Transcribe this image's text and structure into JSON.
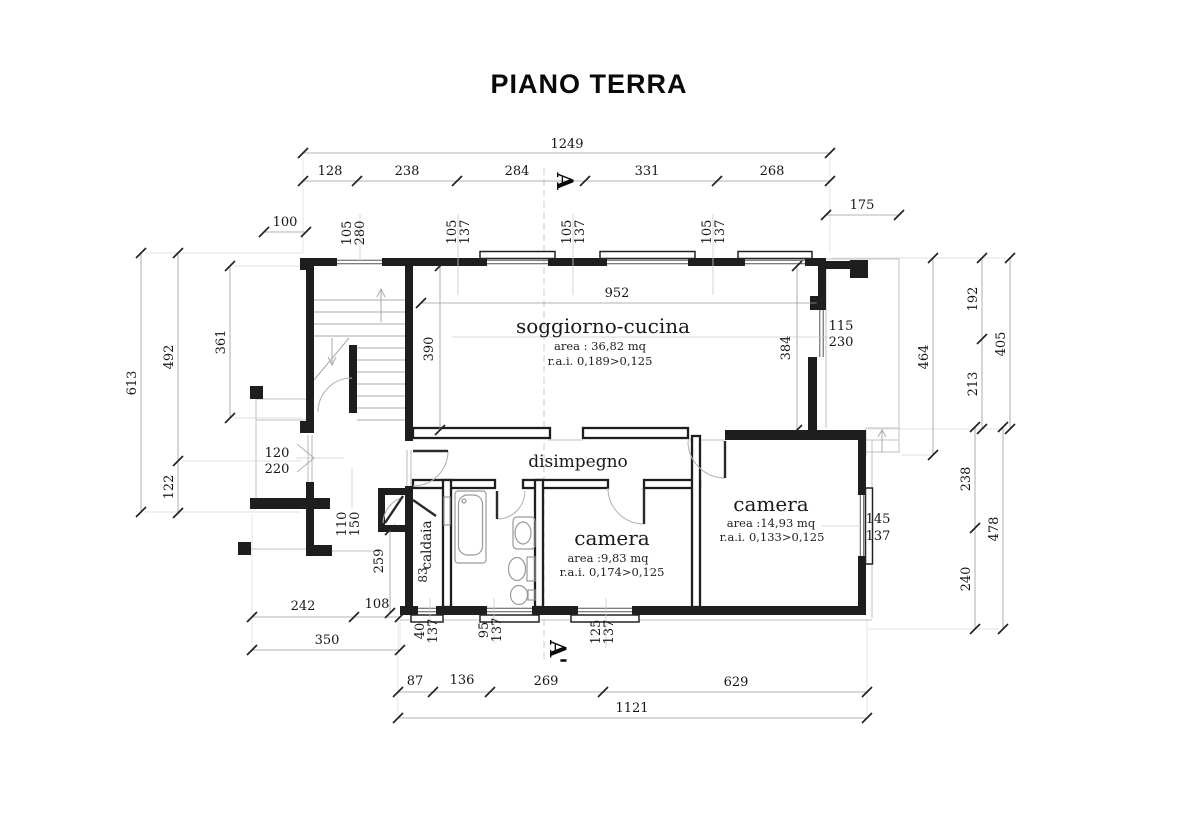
{
  "title": "PIANO TERRA",
  "section": {
    "marker_top": "A",
    "marker_bottom": "A'"
  },
  "rooms": {
    "soggiorno": {
      "name": "soggiorno-cucina",
      "area": "area : 36,82 mq",
      "rai": "r.a.i. 0,189>0,125"
    },
    "disimpegno": {
      "name": "disimpegno"
    },
    "camera_small": {
      "name": "camera",
      "area": "area :9,83 mq",
      "rai": "r.a.i. 0,174>0,125"
    },
    "camera_large": {
      "name": "camera",
      "area": "area :14,93 mq",
      "rai": "r.a.i. 0,133>0,125"
    },
    "caldaia": {
      "name": "caldaia"
    }
  },
  "dims": {
    "top_total": "1249",
    "top_chain": [
      "128",
      "238",
      "284",
      "331",
      "268"
    ],
    "porch_width": "100",
    "terrace_width": "175",
    "left_total": "613",
    "left_upper": "492",
    "left_lower": "122",
    "stair_depth": "361",
    "right_soggiorno": "464",
    "right_upper_chain": [
      "192",
      "213"
    ],
    "right_upper_total": "405",
    "right_lower_chain": [
      "238",
      "240"
    ],
    "right_lower_total": "478",
    "bottom_left_chain": [
      "242",
      "108"
    ],
    "bottom_left_total": "350",
    "bottom_chain": [
      "87",
      "136",
      "269",
      "629"
    ],
    "bottom_total": "1121",
    "soggiorno_width": "952",
    "soggiorno_depth_left": "390",
    "soggiorno_depth_right": "384",
    "caldaia_depth": "259",
    "caldaia_width": "83"
  },
  "openings": {
    "stair_window": {
      "w": "105",
      "h": "280"
    },
    "window_top_1": {
      "w": "105",
      "h": "137"
    },
    "window_top_2": {
      "w": "105",
      "h": "137"
    },
    "window_top_3": {
      "w": "105",
      "h": "137"
    },
    "balcony_door": {
      "w": "115",
      "h": "230"
    },
    "entrance_door": {
      "w": "120",
      "h": "220"
    },
    "side_door": {
      "w": "110",
      "h": "150"
    },
    "caldaia_window": {
      "w": "40",
      "h": "137"
    },
    "bath_window": {
      "w": "95",
      "h": "137"
    },
    "camera_small_window": {
      "w": "125",
      "h": "137"
    },
    "camera_large_window": {
      "w": "145",
      "h": "137"
    }
  }
}
